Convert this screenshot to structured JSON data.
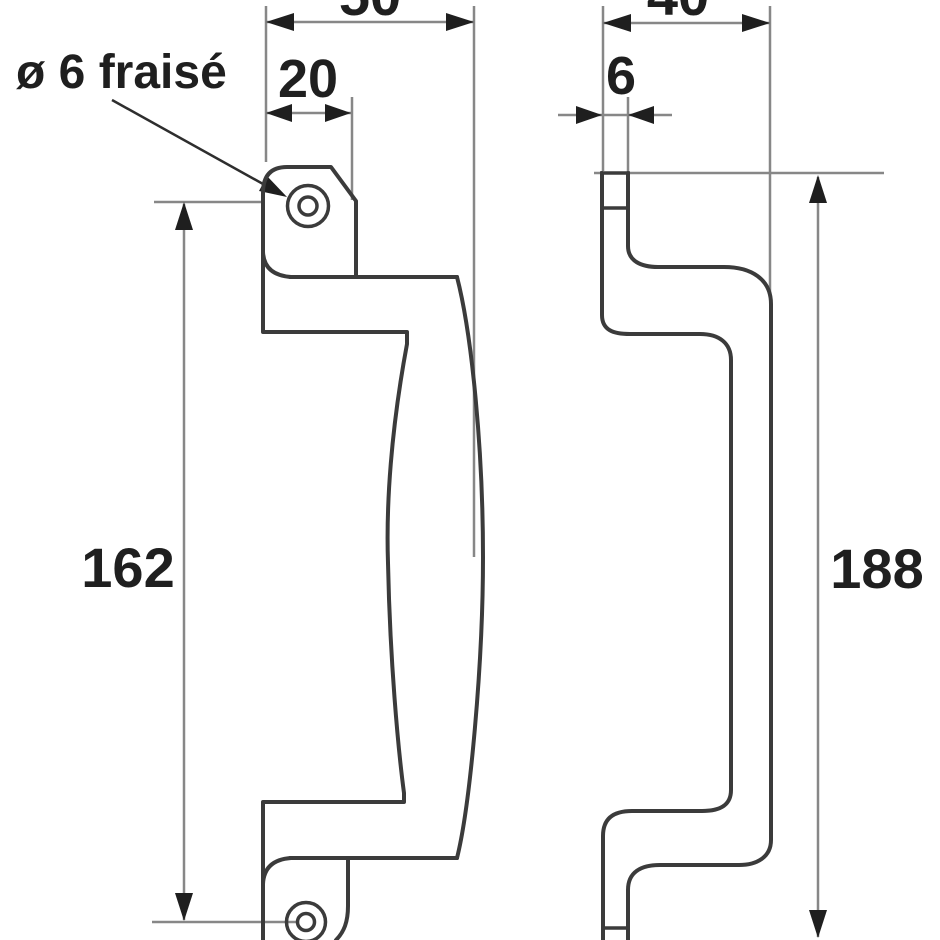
{
  "drawing": {
    "kind": "technical-drawing-two-views-pull-handle",
    "hole_callout": "ø 6 fraisé",
    "front_view": {
      "overall_width": "50",
      "lug_width": "20",
      "fixing_centers": "162"
    },
    "side_view": {
      "overall_depth": "40",
      "plate_thickness": "6",
      "overall_height": "188"
    },
    "colors": {
      "background": "#ffffff",
      "part_outline": "#3b3b3b",
      "dimension_line": "#878787",
      "arrow_and_text": "#1f1f1f"
    }
  }
}
